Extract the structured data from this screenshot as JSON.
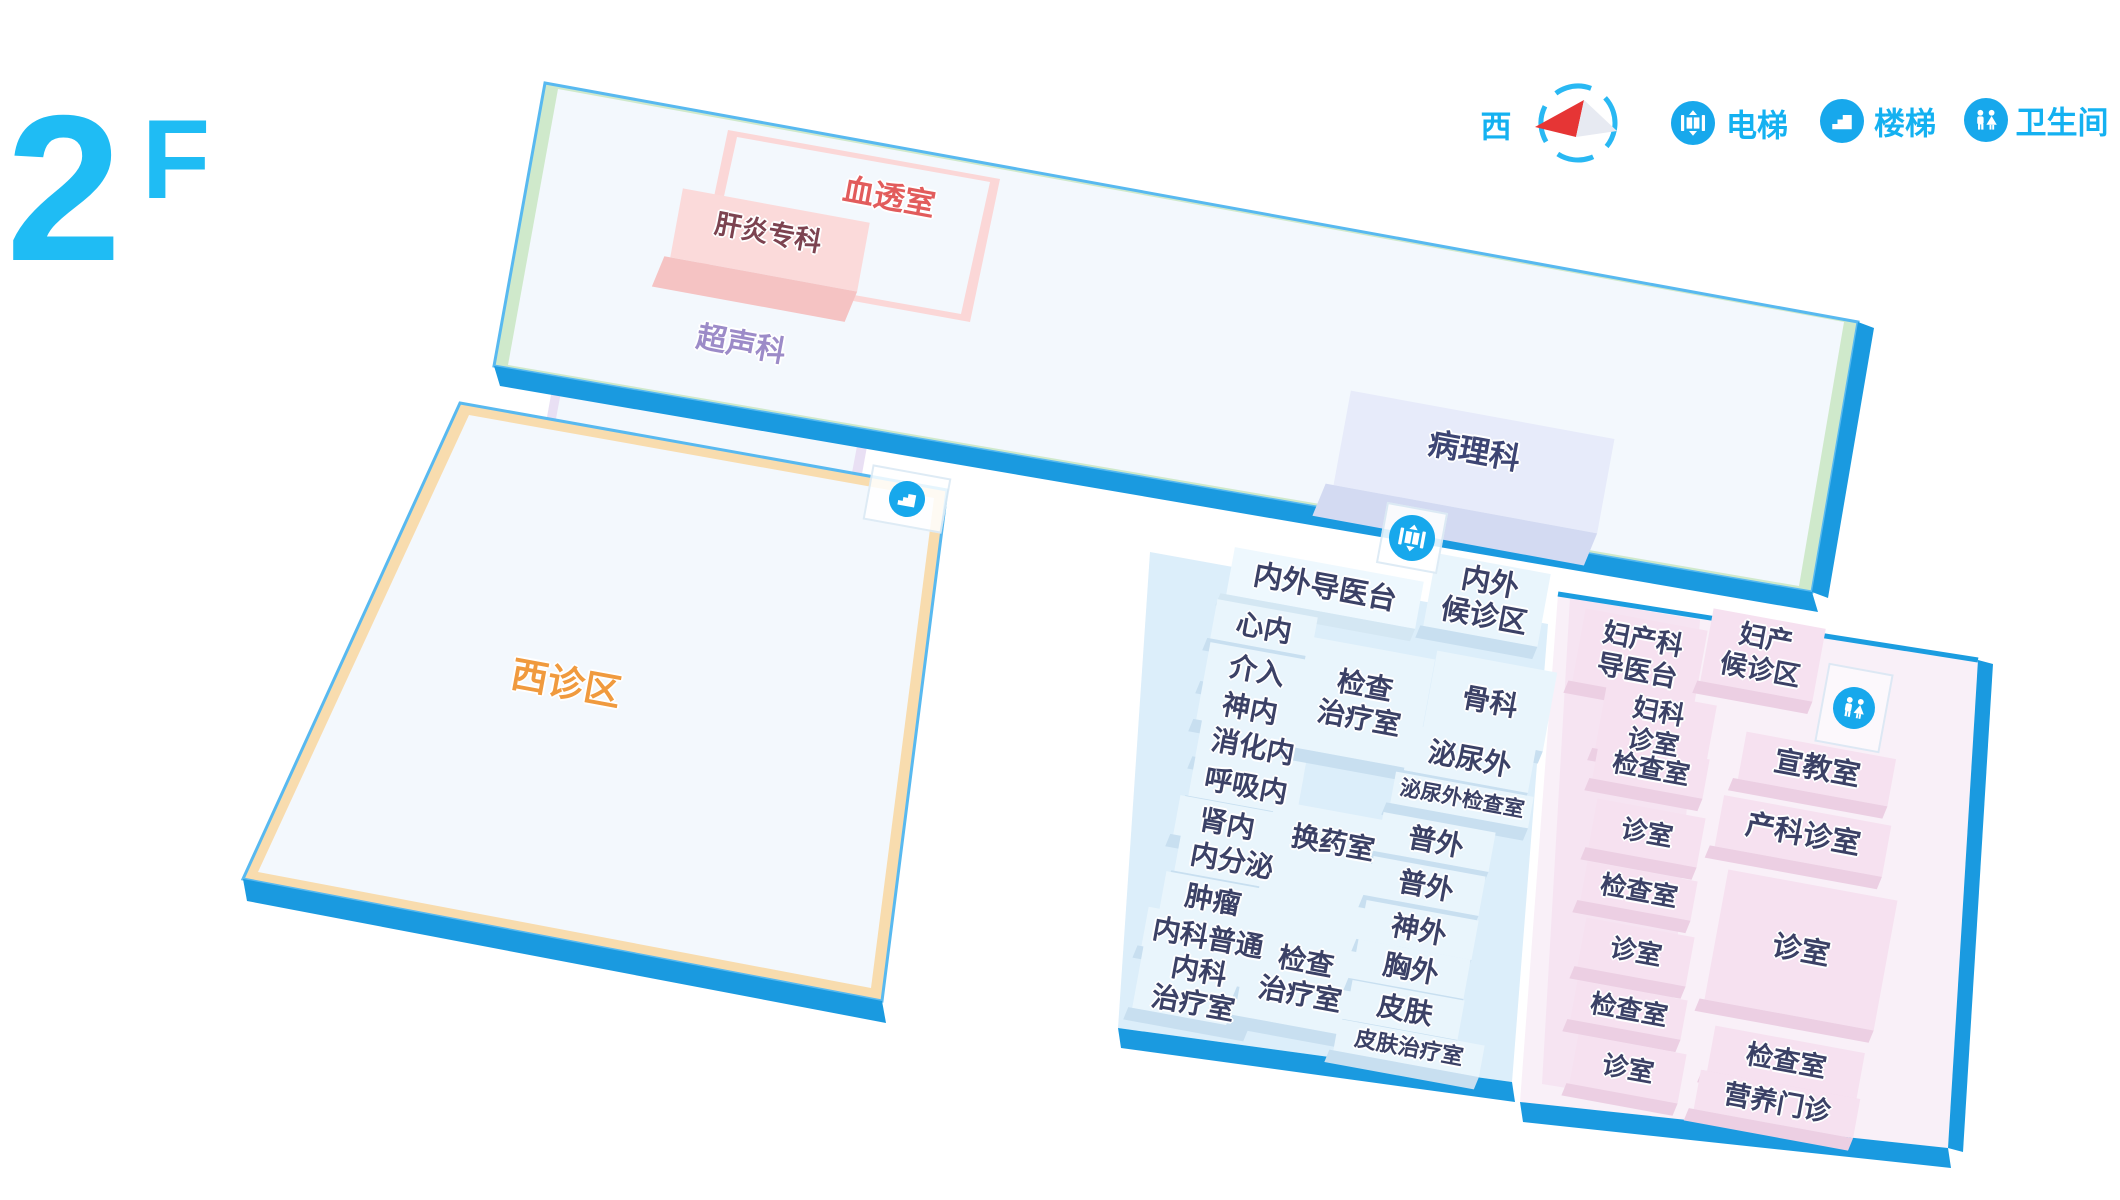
{
  "floor": {
    "number": "2",
    "suffix": "F"
  },
  "legend": {
    "compass_label": "西",
    "elevator": "电梯",
    "stairs": "楼梯",
    "restroom": "卫生间"
  },
  "colors": {
    "accent_cyan": "#14b1f1",
    "slab_blue": "#1a9ae0",
    "west_label_orange": "#f09a3e",
    "hemodialysis_red": "#e25c5c",
    "ultrasound_purple": "#9c8bc8",
    "room_text_navy": "#3b4166"
  },
  "north_building": {
    "hemodialysis": "血透室",
    "hepatitis_clinic": "肝炎专科",
    "ultrasound": "超声科",
    "pathology": "病理科"
  },
  "west_building": {
    "label": "西诊区"
  },
  "internal_external_area": {
    "guide_desk": "内外导医台",
    "waiting_area": "内外\n候诊区",
    "left_rooms": [
      "心内",
      "介入",
      "神内",
      "消化内",
      "呼吸内",
      "肾内",
      "内分泌",
      "肿瘤",
      "内科普通",
      "内科\n治疗室"
    ],
    "middle_rooms": [
      "检查\n治疗室",
      "换药室",
      "检查\n治疗室"
    ],
    "right_rooms": [
      "骨科",
      "泌尿外",
      "泌尿外检查室",
      "普外",
      "普外",
      "神外",
      "胸外",
      "皮肤",
      "皮肤治疗室"
    ]
  },
  "obstetrics_area": {
    "guide_desk": "妇产科\n导医台",
    "waiting_area": "妇产\n候诊区",
    "left_rooms": [
      "妇科\n诊室",
      "检查室",
      "诊室",
      "检查室",
      "诊室",
      "检查室",
      "诊室"
    ],
    "right_rooms": [
      "宣教室",
      "产科诊室",
      "诊室",
      "检查室",
      "营养门诊"
    ]
  }
}
